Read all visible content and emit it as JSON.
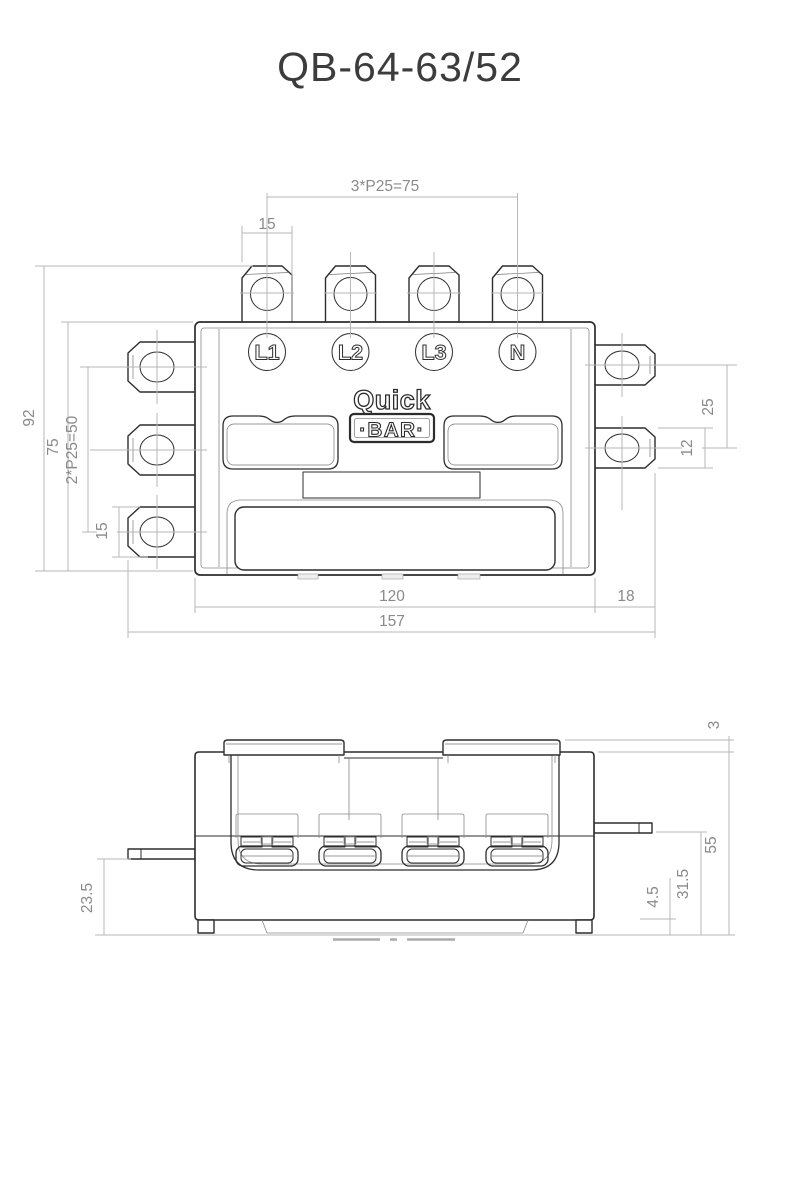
{
  "title": "QB-64-63/52",
  "colors": {
    "drawing_line": "#2d2d2d",
    "dimension_line": "#b7b7b7",
    "dimension_text": "#8a8a8a",
    "title_text": "#3c3c3c",
    "background": "#ffffff"
  },
  "top_view": {
    "terminals": {
      "t1": "L1",
      "t2": "L2",
      "t3": "L3",
      "t4": "N"
    },
    "logo": {
      "top": "Quick",
      "bottom": "·BAR·"
    },
    "dims": {
      "top_pitch": "3*P25=75",
      "top_tab_width": "15",
      "overall_height": "92",
      "body_height": "75",
      "left_pitch": "2*P25=50",
      "left_tab_width": "15",
      "right_pitch": "25",
      "right_tab_width": "12",
      "body_width": "120",
      "right_tab_length": "18",
      "overall_width": "157"
    }
  },
  "side_view": {
    "dims": {
      "cover_height": "3",
      "body_height": "55",
      "right_tab_offset": "31.5",
      "foot_height": "4.5",
      "left_tab_offset": "23.5"
    }
  }
}
